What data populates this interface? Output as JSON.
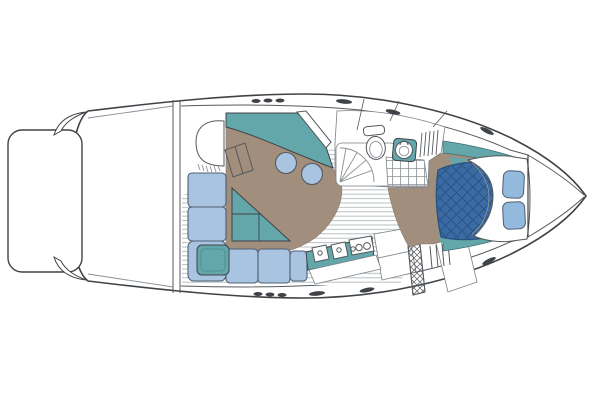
{
  "meta": {
    "title": "Motor yacht interior floor plan (top view, bow facing right)",
    "diagram_type": "boat-floorplan",
    "visible_text": "none"
  },
  "palette": {
    "background": "#ffffff",
    "outline": "#3f4347",
    "line_soft": "#8a9094",
    "line_mid": "#55595d",
    "room_stroke": "#7a8085",
    "teal": "#64a7ab",
    "teal_stroke": "#3c6e72",
    "tan": "#a18e7c",
    "tan_stroke": "#8a7a6a",
    "cushion_blue": "#a9c4e1",
    "cushion_stroke": "#4f5f73",
    "pillow_blue": "#93b9dc",
    "mattress_blue": "#3b6ba4",
    "quilt_line": "#27517f",
    "teak_line": "#b9bfc3"
  },
  "features": [
    {
      "id": "swim-platform",
      "label": "swim platform (stern)"
    },
    {
      "id": "transom-bulkhead",
      "label": "transom bulkhead"
    },
    {
      "id": "helm-seat",
      "label": "helm seat"
    },
    {
      "id": "dashboard",
      "label": "helm console / dashboard (teal)"
    },
    {
      "id": "windshield-walkthrough",
      "label": "windshield walk-through"
    },
    {
      "id": "console",
      "label": "cockpit console (tan)"
    },
    {
      "id": "bar-stools",
      "label": "two pedestal stools"
    },
    {
      "id": "sofa",
      "label": "L-shaped cockpit sofa (blue cushions)"
    },
    {
      "id": "corner-table",
      "label": "teal corner seat/table"
    },
    {
      "id": "cocktail-table",
      "label": "teal triangular table"
    },
    {
      "id": "galley",
      "label": "galley counter with twin sinks and burners"
    },
    {
      "id": "companionway",
      "label": "companionway hatch and steps"
    },
    {
      "id": "head",
      "label": "head compartment"
    },
    {
      "id": "shower",
      "label": "shower stall with door swing"
    },
    {
      "id": "toilet",
      "label": "toilet"
    },
    {
      "id": "vanity-sink",
      "label": "vanity sink on teal counter"
    },
    {
      "id": "hanging-locker",
      "label": "hanging locker"
    },
    {
      "id": "cabin-sole",
      "label": "teak-striped cabin sole"
    },
    {
      "id": "v-berth",
      "label": "forward V-berth with quilted mattress"
    },
    {
      "id": "duvet",
      "label": "white duvet"
    },
    {
      "id": "pillows",
      "label": "two pillows"
    },
    {
      "id": "forward-bulkhead",
      "label": "forward bulkhead"
    },
    {
      "id": "cleats",
      "label": "deck cleats and vents"
    }
  ]
}
